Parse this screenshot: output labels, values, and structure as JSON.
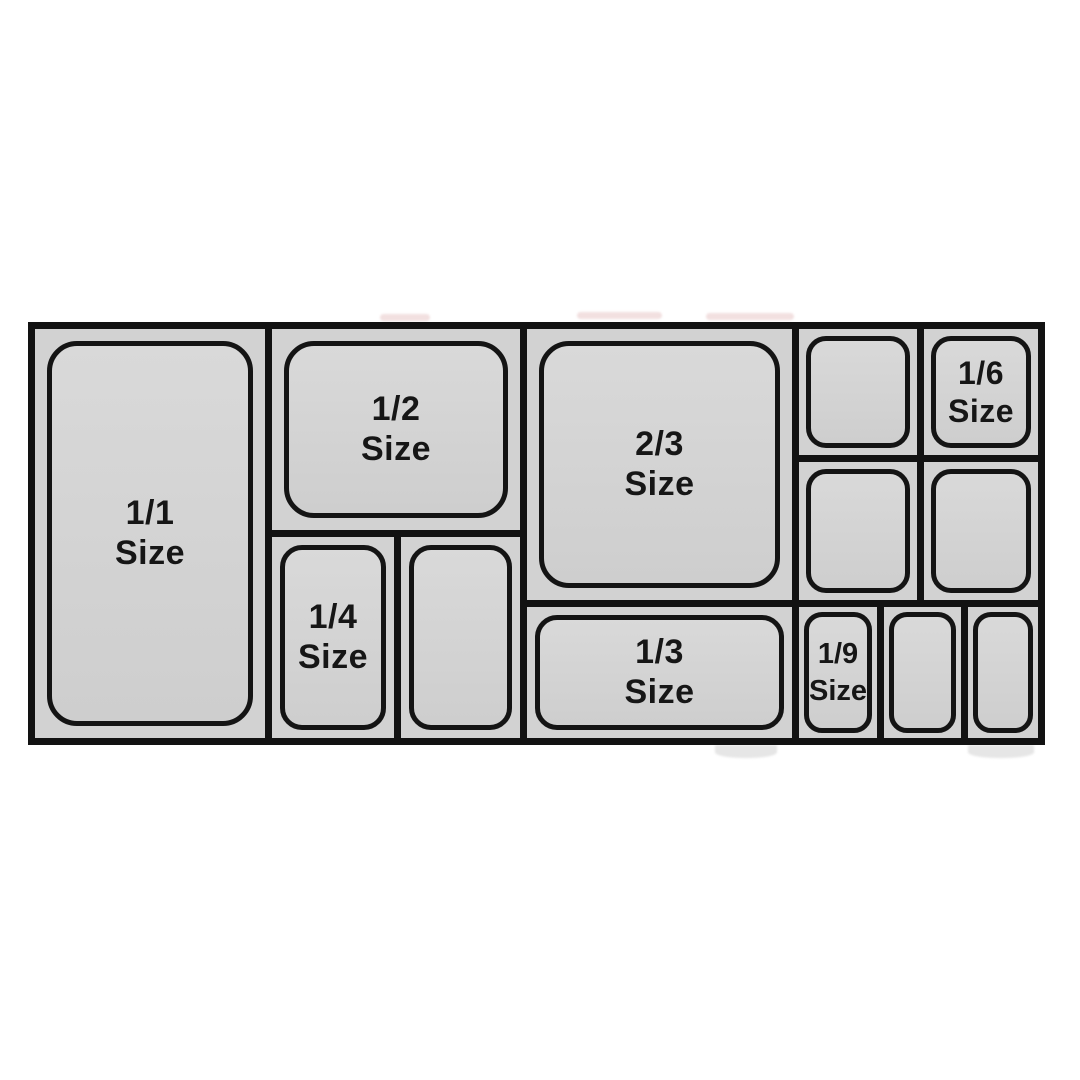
{
  "diagram": {
    "title_implicit": "Gastronorm pan size layout",
    "colors": {
      "background": "#ffffff",
      "border": "#121212",
      "cell_fill": "#d2d2d2",
      "pan_fill": "#d5d5d5",
      "label": "#161616"
    },
    "pans": {
      "full": {
        "fraction": "1/1",
        "word": "Size"
      },
      "half": {
        "fraction": "1/2",
        "word": "Size"
      },
      "two_thirds": {
        "fraction": "2/3",
        "word": "Size"
      },
      "quarter": {
        "fraction": "1/4",
        "word": "Size"
      },
      "third": {
        "fraction": "1/3",
        "word": "Size"
      },
      "sixth": {
        "fraction": "1/6",
        "word": "Size"
      },
      "ninth": {
        "fraction": "1/9",
        "word": "Size"
      }
    }
  }
}
